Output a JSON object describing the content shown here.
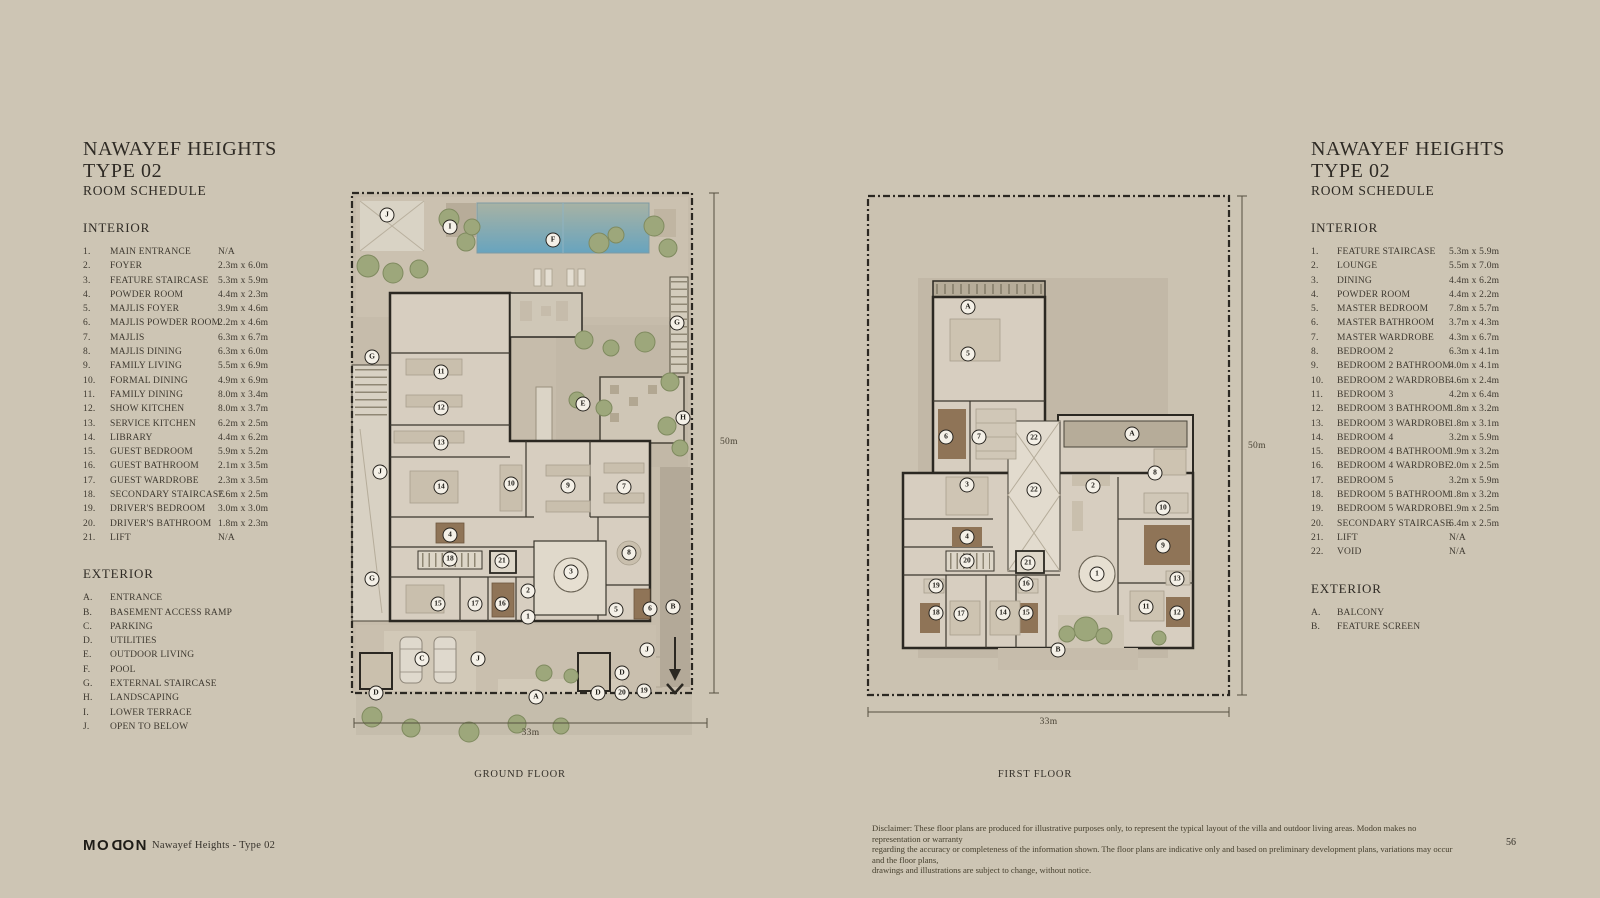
{
  "left_schedule": {
    "title_line1": "NAWAYEF HEIGHTS",
    "title_line2": "TYPE 02",
    "title_line3": "ROOM SCHEDULE",
    "interior_heading": "INTERIOR",
    "exterior_heading": "EXTERIOR",
    "interior": [
      {
        "num": "1.",
        "name": "MAIN ENTRANCE",
        "dim": "N/A"
      },
      {
        "num": "2.",
        "name": "FOYER",
        "dim": "2.3m x 6.0m"
      },
      {
        "num": "3.",
        "name": "FEATURE STAIRCASE",
        "dim": "5.3m x 5.9m"
      },
      {
        "num": "4.",
        "name": "POWDER ROOM",
        "dim": "4.4m x 2.3m"
      },
      {
        "num": "5.",
        "name": "MAJLIS FOYER",
        "dim": "3.9m x 4.6m"
      },
      {
        "num": "6.",
        "name": "MAJLIS POWDER ROOM",
        "dim": "2.2m x 4.6m"
      },
      {
        "num": "7.",
        "name": "MAJLIS",
        "dim": "6.3m x 6.7m"
      },
      {
        "num": "8.",
        "name": "MAJLIS DINING",
        "dim": "6.3m x 6.0m"
      },
      {
        "num": "9.",
        "name": "FAMILY LIVING",
        "dim": "5.5m x 6.9m"
      },
      {
        "num": "10.",
        "name": "FORMAL DINING",
        "dim": "4.9m x 6.9m"
      },
      {
        "num": "11.",
        "name": "FAMILY DINING",
        "dim": "8.0m x 3.4m"
      },
      {
        "num": "12.",
        "name": "SHOW KITCHEN",
        "dim": "8.0m x 3.7m"
      },
      {
        "num": "13.",
        "name": "SERVICE KITCHEN",
        "dim": "6.2m x 2.5m"
      },
      {
        "num": "14.",
        "name": "LIBRARY",
        "dim": "4.4m x 6.2m"
      },
      {
        "num": "15.",
        "name": "GUEST BEDROOM",
        "dim": "5.9m x 5.2m"
      },
      {
        "num": "16.",
        "name": "GUEST BATHROOM",
        "dim": "2.1m x 3.5m"
      },
      {
        "num": "17.",
        "name": "GUEST WARDROBE",
        "dim": "2.3m x 3.5m"
      },
      {
        "num": "18.",
        "name": "SECONDARY STAIRCASE",
        "dim": "7.6m x 2.5m"
      },
      {
        "num": "19.",
        "name": "DRIVER'S BEDROOM",
        "dim": "3.0m x 3.0m"
      },
      {
        "num": "20.",
        "name": "DRIVER'S BATHROOM",
        "dim": "1.8m x 2.3m"
      },
      {
        "num": "21.",
        "name": "LIFT",
        "dim": "N/A"
      }
    ],
    "exterior": [
      {
        "num": "A.",
        "name": "ENTRANCE"
      },
      {
        "num": "B.",
        "name": "BASEMENT ACCESS RAMP"
      },
      {
        "num": "C.",
        "name": "PARKING"
      },
      {
        "num": "D.",
        "name": "UTILITIES"
      },
      {
        "num": "E.",
        "name": "OUTDOOR LIVING"
      },
      {
        "num": "F.",
        "name": "POOL"
      },
      {
        "num": "G.",
        "name": "EXTERNAL STAIRCASE"
      },
      {
        "num": "H.",
        "name": "LANDSCAPING"
      },
      {
        "num": "I.",
        "name": "LOWER TERRACE"
      },
      {
        "num": "J.",
        "name": "OPEN TO BELOW"
      }
    ]
  },
  "right_schedule": {
    "title_line1": "NAWAYEF HEIGHTS",
    "title_line2": "TYPE 02",
    "title_line3": "ROOM SCHEDULE",
    "interior_heading": "INTERIOR",
    "exterior_heading": "EXTERIOR",
    "interior": [
      {
        "num": "1.",
        "name": "FEATURE STAIRCASE",
        "dim": "5.3m x 5.9m"
      },
      {
        "num": "2.",
        "name": "LOUNGE",
        "dim": "5.5m x 7.0m"
      },
      {
        "num": "3.",
        "name": "DINING",
        "dim": "4.4m x 6.2m"
      },
      {
        "num": "4.",
        "name": "POWDER ROOM",
        "dim": "4.4m x 2.2m"
      },
      {
        "num": "5.",
        "name": "MASTER BEDROOM",
        "dim": "7.8m x 5.7m"
      },
      {
        "num": "6.",
        "name": "MASTER BATHROOM",
        "dim": "3.7m x 4.3m"
      },
      {
        "num": "7.",
        "name": "MASTER WARDROBE",
        "dim": "4.3m x 6.7m"
      },
      {
        "num": "8.",
        "name": "BEDROOM 2",
        "dim": "6.3m x 4.1m"
      },
      {
        "num": "9.",
        "name": "BEDROOM 2 BATHROOM",
        "dim": "4.0m x 4.1m"
      },
      {
        "num": "10.",
        "name": "BEDROOM 2 WARDROBE",
        "dim": "4.6m x 2.4m"
      },
      {
        "num": "11.",
        "name": "BEDROOM 3",
        "dim": "4.2m x 6.4m"
      },
      {
        "num": "12.",
        "name": "BEDROOM 3 BATHROOM",
        "dim": "1.8m x 3.2m"
      },
      {
        "num": "13.",
        "name": "BEDROOM 3 WARDROBE",
        "dim": "1.8m x 3.1m"
      },
      {
        "num": "14.",
        "name": "BEDROOM 4",
        "dim": "3.2m x 5.9m"
      },
      {
        "num": "15.",
        "name": "BEDROOM 4 BATHROOM",
        "dim": "1.9m x 3.2m"
      },
      {
        "num": "16.",
        "name": "BEDROOM 4 WARDROBE",
        "dim": "2.0m x 2.5m"
      },
      {
        "num": "17.",
        "name": "BEDROOM 5",
        "dim": "3.2m x 5.9m"
      },
      {
        "num": "18.",
        "name": "BEDROOM 5 BATHROOM",
        "dim": "1.8m x 3.2m"
      },
      {
        "num": "19.",
        "name": "BEDROOM 5 WARDROBE",
        "dim": "1.9m x 2.5m"
      },
      {
        "num": "20.",
        "name": "SECONDARY STAIRCASE",
        "dim": "6.4m x 2.5m"
      },
      {
        "num": "21.",
        "name": "LIFT",
        "dim": "N/A"
      },
      {
        "num": "22.",
        "name": "VOID",
        "dim": "N/A"
      }
    ],
    "exterior": [
      {
        "num": "A.",
        "name": "BALCONY"
      },
      {
        "num": "B.",
        "name": "FEATURE SCREEN"
      }
    ]
  },
  "ground_floor": {
    "label": "GROUND FLOOR",
    "height_label": "50m",
    "width_label": "33m",
    "markers": [
      {
        "label": "J",
        "x": 39,
        "y": 30
      },
      {
        "label": "I",
        "x": 102,
        "y": 42
      },
      {
        "label": "F",
        "x": 205,
        "y": 55
      },
      {
        "label": "G",
        "x": 329,
        "y": 138
      },
      {
        "label": "G",
        "x": 24,
        "y": 172
      },
      {
        "label": "11",
        "x": 93,
        "y": 187
      },
      {
        "label": "12",
        "x": 93,
        "y": 223
      },
      {
        "label": "13",
        "x": 93,
        "y": 258
      },
      {
        "label": "E",
        "x": 235,
        "y": 219
      },
      {
        "label": "H",
        "x": 335,
        "y": 233
      },
      {
        "label": "J",
        "x": 32,
        "y": 287
      },
      {
        "label": "14",
        "x": 93,
        "y": 302
      },
      {
        "label": "10",
        "x": 163,
        "y": 299
      },
      {
        "label": "9",
        "x": 220,
        "y": 301
      },
      {
        "label": "7",
        "x": 276,
        "y": 302
      },
      {
        "label": "4",
        "x": 102,
        "y": 350
      },
      {
        "label": "18",
        "x": 102,
        "y": 374
      },
      {
        "label": "21",
        "x": 154,
        "y": 376
      },
      {
        "label": "3",
        "x": 223,
        "y": 387
      },
      {
        "label": "8",
        "x": 281,
        "y": 368
      },
      {
        "label": "G",
        "x": 24,
        "y": 394
      },
      {
        "label": "15",
        "x": 90,
        "y": 419
      },
      {
        "label": "17",
        "x": 127,
        "y": 419
      },
      {
        "label": "16",
        "x": 154,
        "y": 419
      },
      {
        "label": "2",
        "x": 180,
        "y": 406
      },
      {
        "label": "1",
        "x": 180,
        "y": 432
      },
      {
        "label": "5",
        "x": 268,
        "y": 425
      },
      {
        "label": "6",
        "x": 302,
        "y": 424
      },
      {
        "label": "B",
        "x": 325,
        "y": 422
      },
      {
        "label": "C",
        "x": 74,
        "y": 474
      },
      {
        "label": "J",
        "x": 130,
        "y": 474
      },
      {
        "label": "J",
        "x": 299,
        "y": 465
      },
      {
        "label": "D",
        "x": 28,
        "y": 508
      },
      {
        "label": "A",
        "x": 188,
        "y": 512
      },
      {
        "label": "D",
        "x": 250,
        "y": 508
      },
      {
        "label": "D",
        "x": 274,
        "y": 488
      },
      {
        "label": "20",
        "x": 274,
        "y": 508
      },
      {
        "label": "19",
        "x": 296,
        "y": 506
      }
    ]
  },
  "first_floor": {
    "label": "FIRST FLOOR",
    "height_label": "50m",
    "width_label": "33m",
    "markers": [
      {
        "label": "A",
        "x": 110,
        "y": 124
      },
      {
        "label": "5",
        "x": 110,
        "y": 171
      },
      {
        "label": "6",
        "x": 88,
        "y": 254
      },
      {
        "label": "7",
        "x": 121,
        "y": 254
      },
      {
        "label": "22",
        "x": 176,
        "y": 255
      },
      {
        "label": "A",
        "x": 274,
        "y": 251
      },
      {
        "label": "3",
        "x": 109,
        "y": 302
      },
      {
        "label": "22",
        "x": 176,
        "y": 307
      },
      {
        "label": "2",
        "x": 235,
        "y": 303
      },
      {
        "label": "8",
        "x": 297,
        "y": 290
      },
      {
        "label": "10",
        "x": 305,
        "y": 325
      },
      {
        "label": "9",
        "x": 305,
        "y": 363
      },
      {
        "label": "4",
        "x": 109,
        "y": 354
      },
      {
        "label": "20",
        "x": 109,
        "y": 378
      },
      {
        "label": "21",
        "x": 170,
        "y": 380
      },
      {
        "label": "1",
        "x": 239,
        "y": 391
      },
      {
        "label": "19",
        "x": 78,
        "y": 403
      },
      {
        "label": "16",
        "x": 168,
        "y": 401
      },
      {
        "label": "13",
        "x": 319,
        "y": 396
      },
      {
        "label": "18",
        "x": 78,
        "y": 430
      },
      {
        "label": "17",
        "x": 103,
        "y": 431
      },
      {
        "label": "14",
        "x": 145,
        "y": 430
      },
      {
        "label": "15",
        "x": 168,
        "y": 430
      },
      {
        "label": "11",
        "x": 288,
        "y": 424
      },
      {
        "label": "12",
        "x": 319,
        "y": 430
      },
      {
        "label": "B",
        "x": 200,
        "y": 467
      }
    ]
  },
  "footer": {
    "logo_prefix": "MO",
    "logo_d": "D",
    "logo_suffix": "ON",
    "doc_title": "Nawayef Heights - Type 02",
    "disclaimer_lines": [
      "Disclaimer: These floor plans are produced for illustrative purposes only, to represent the typical layout of the villa and outdoor living areas.  Modon makes no representation or warranty",
      "regarding the accuracy or completeness of the information shown.  The floor plans are indicative only and based on preliminary development plans, variations may occur and the floor plans,",
      "drawings and illustrations are subject to change, without notice."
    ],
    "page_number": "56"
  }
}
